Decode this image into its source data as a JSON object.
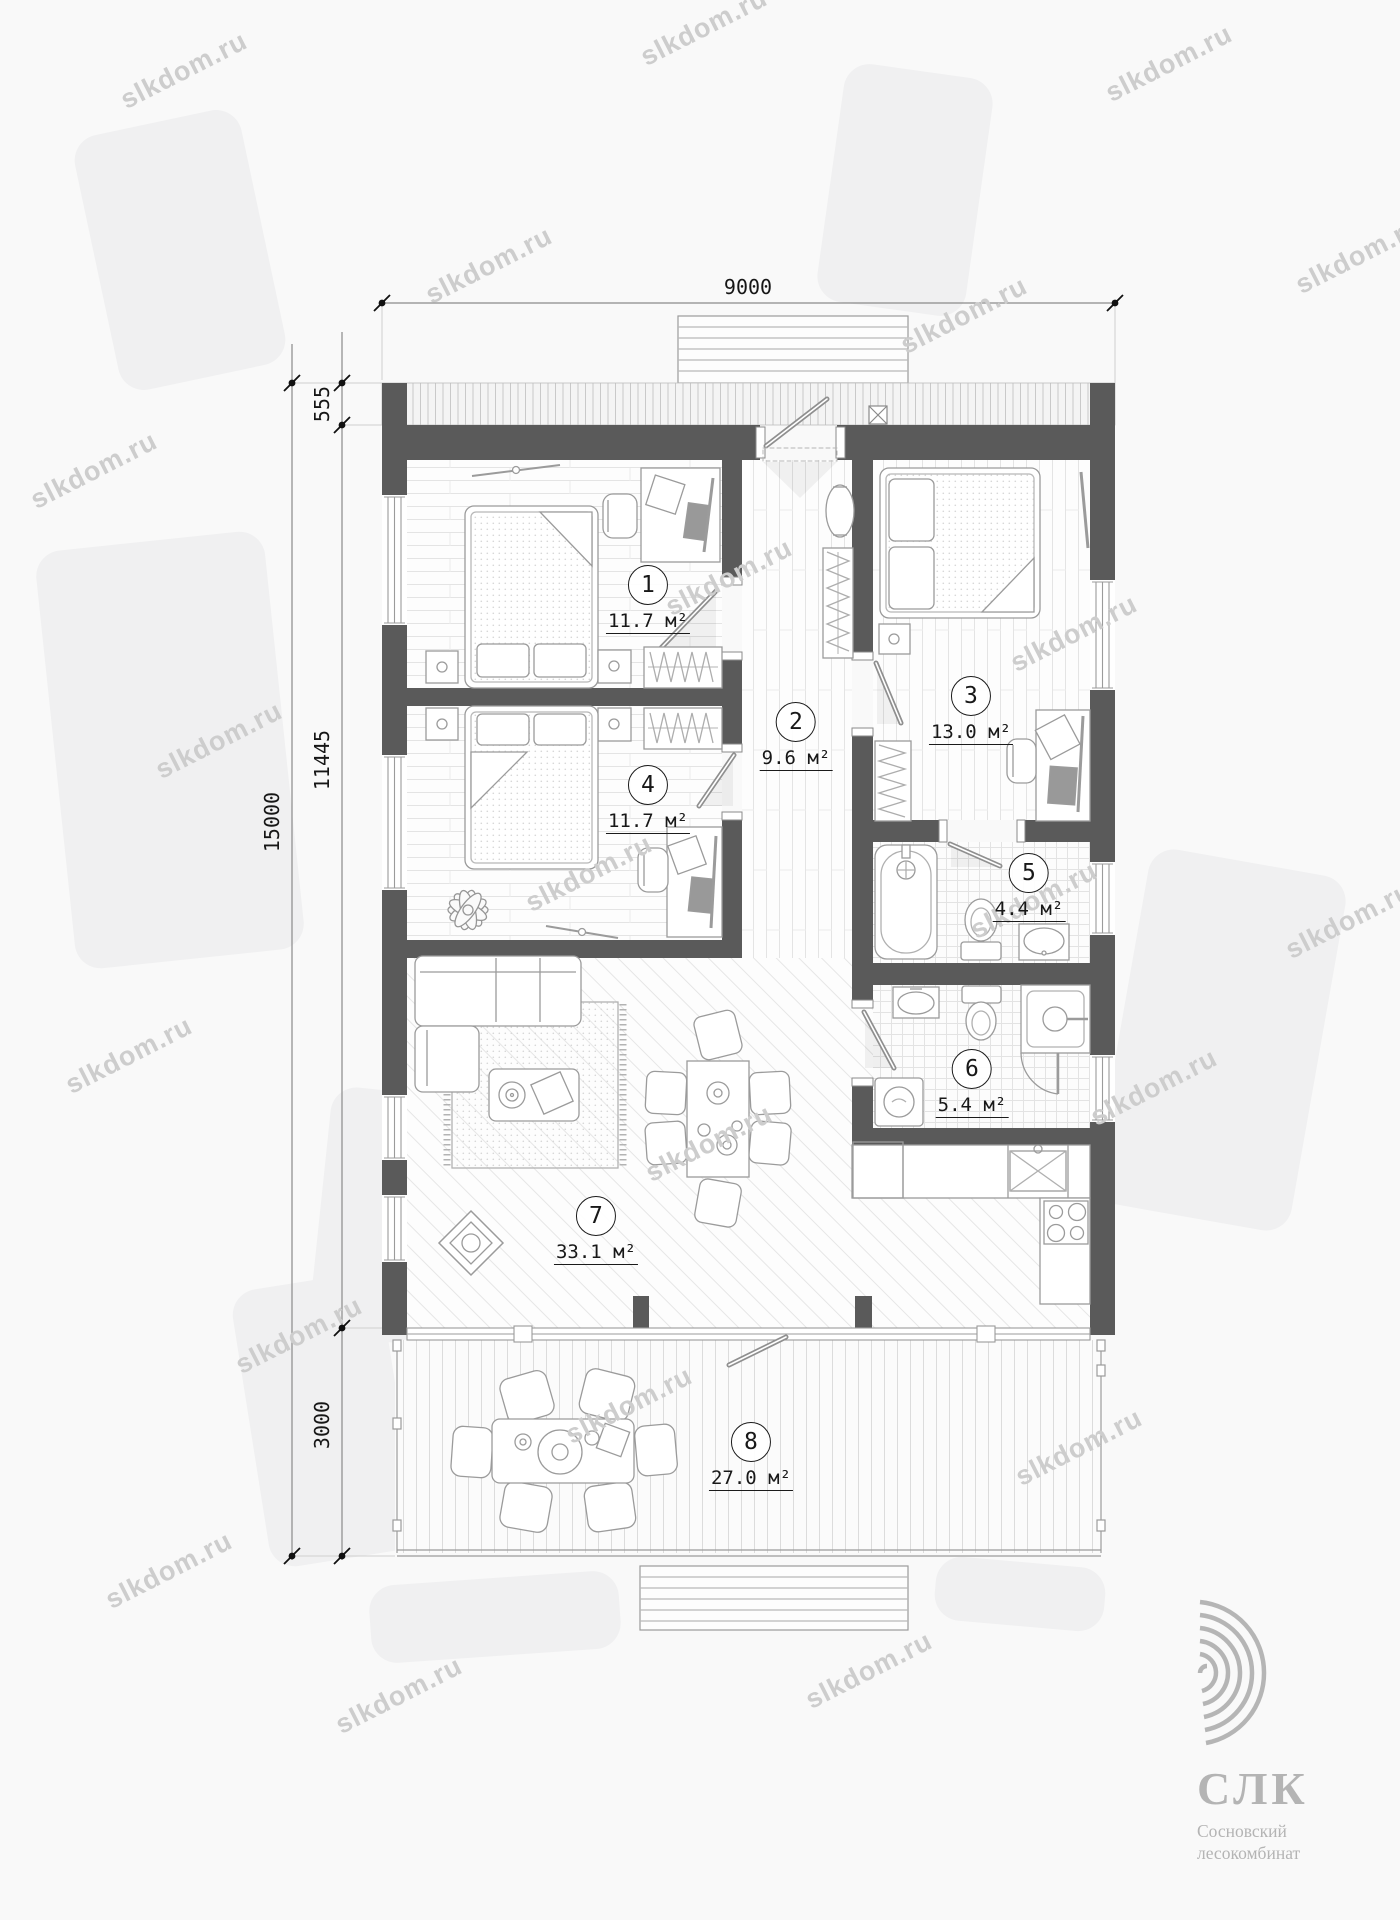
{
  "watermark": {
    "text": "slkdom.ru"
  },
  "dimensions": {
    "top_width": "9000",
    "left_overhang": "555",
    "left_main": "11445",
    "left_total": "15000",
    "left_terrace": "3000"
  },
  "rooms": [
    {
      "number": "1",
      "area": "11.7 м²"
    },
    {
      "number": "2",
      "area": "9.6 м²"
    },
    {
      "number": "3",
      "area": "13.0 м²"
    },
    {
      "number": "4",
      "area": "11.7 м²"
    },
    {
      "number": "5",
      "area": "4.4 м²"
    },
    {
      "number": "6",
      "area": "5.4 м²"
    },
    {
      "number": "7",
      "area": "33.1 м²"
    },
    {
      "number": "8",
      "area": "27.0 м²"
    }
  ],
  "logo": {
    "abbr": "СЛК",
    "line1": "Сосновский",
    "line2": "лесокомбинат"
  },
  "colors": {
    "wall": "#5a5a5a",
    "furniture_line": "#9b9b9b",
    "label": "#1b1b1b",
    "logo_gray": "#b4b4b4",
    "watermark_gray": "#cdcdcd"
  }
}
